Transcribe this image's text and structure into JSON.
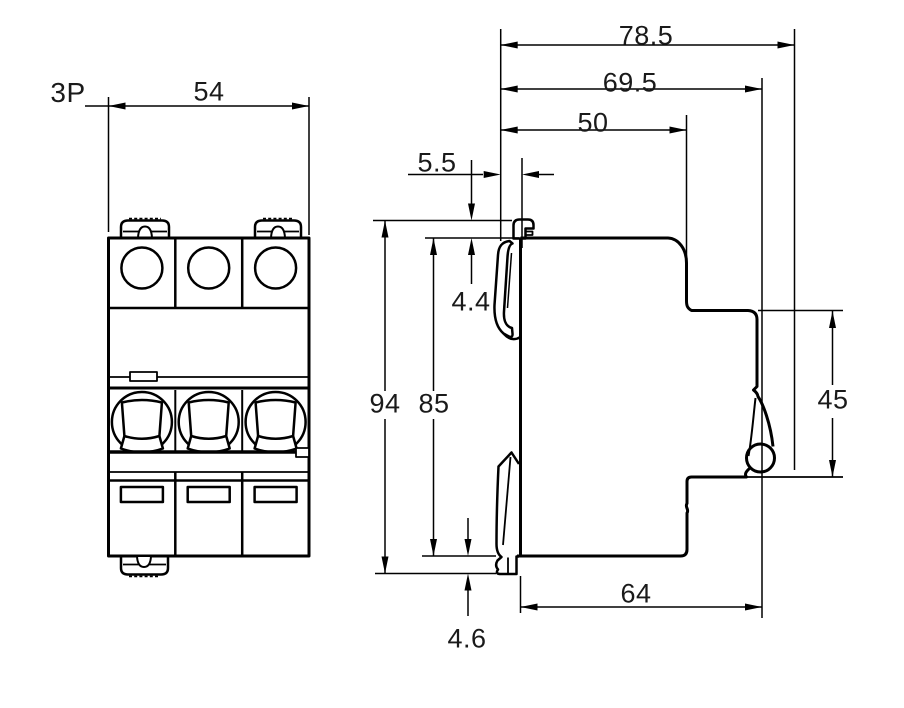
{
  "page": {
    "background": "#ffffff"
  },
  "drawing": {
    "front_view": {
      "pole_label": "3P",
      "dimensions": {
        "width_mm": "54"
      }
    },
    "side_view": {
      "dimensions": {
        "overall_depth_mm": "78.5",
        "depth_to_clip_mm": "69.5",
        "upper_body_depth_mm": "50",
        "clip_protrusion_mm": "5.5",
        "top_clip_offset_mm": "4.4",
        "overall_height_mm": "94",
        "body_height_mm": "85",
        "front_face_height_mm": "45",
        "lower_body_depth_mm": "64",
        "bottom_clip_offset_mm": "4.6"
      }
    },
    "colors": {
      "line": "#000000",
      "text": "#1a1a1a",
      "background": "#ffffff"
    }
  }
}
